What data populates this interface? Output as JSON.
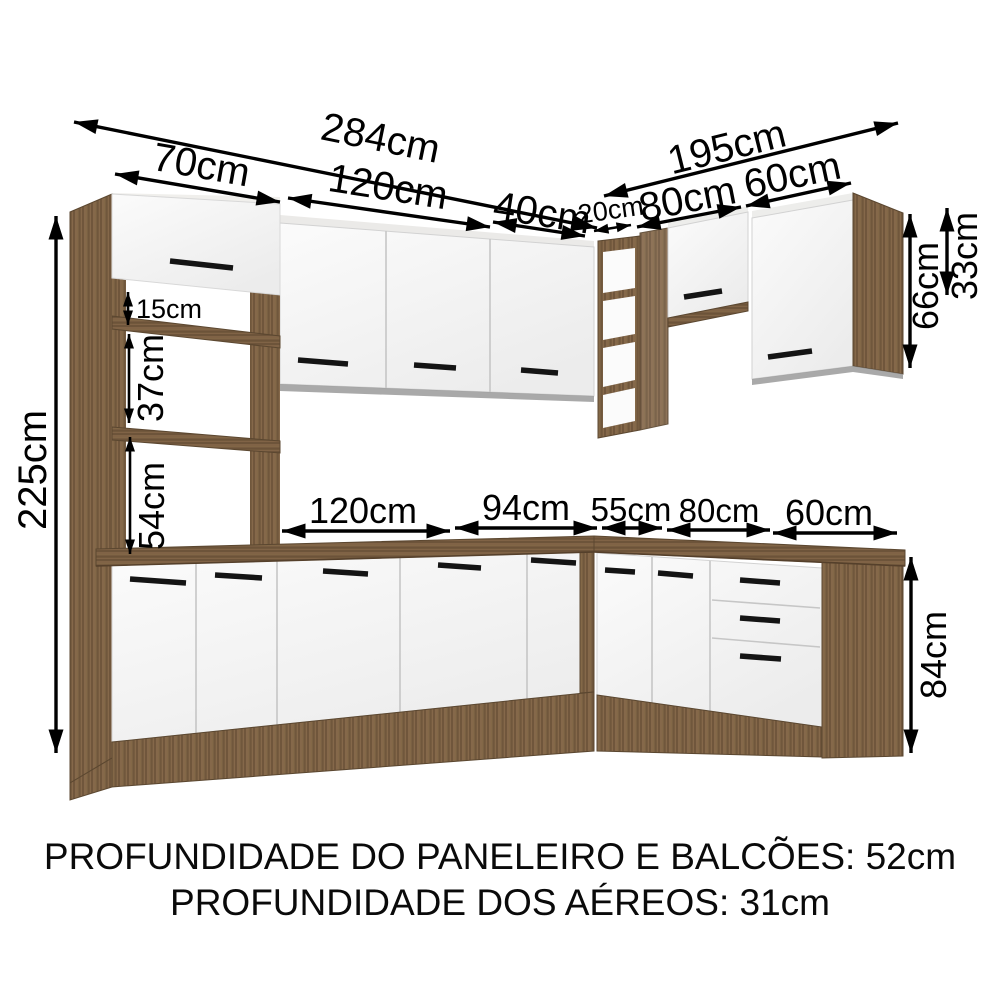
{
  "diagram": {
    "type": "kitchen-cabinet-dimension-diagram",
    "dims": {
      "d284": "284cm",
      "d70": "70cm",
      "d120_top": "120cm",
      "d40": "40cm",
      "d20": "20cm",
      "d80_top": "80cm",
      "d60_top": "60cm",
      "d195": "195cm",
      "d225": "225cm",
      "d15": "15cm",
      "d37": "37cm",
      "d54": "54cm",
      "d66": "66cm",
      "d33": "33cm",
      "d120_base": "120cm",
      "d94": "94cm",
      "d55": "55cm",
      "d80_base": "80cm",
      "d60_base": "60cm",
      "d84": "84cm"
    },
    "colors": {
      "wood": "#85684a",
      "wood_dark": "#6a5238",
      "door_white": "#f4f4f4",
      "handle": "#141414",
      "arrow": "#000000",
      "background": "#ffffff"
    }
  },
  "footer": {
    "line1": "PROFUNDIDADE DO PANELEIRO E BALCÕES: 52cm",
    "line2": "PROFUNDIDADE DOS AÉREOS: 31cm"
  }
}
